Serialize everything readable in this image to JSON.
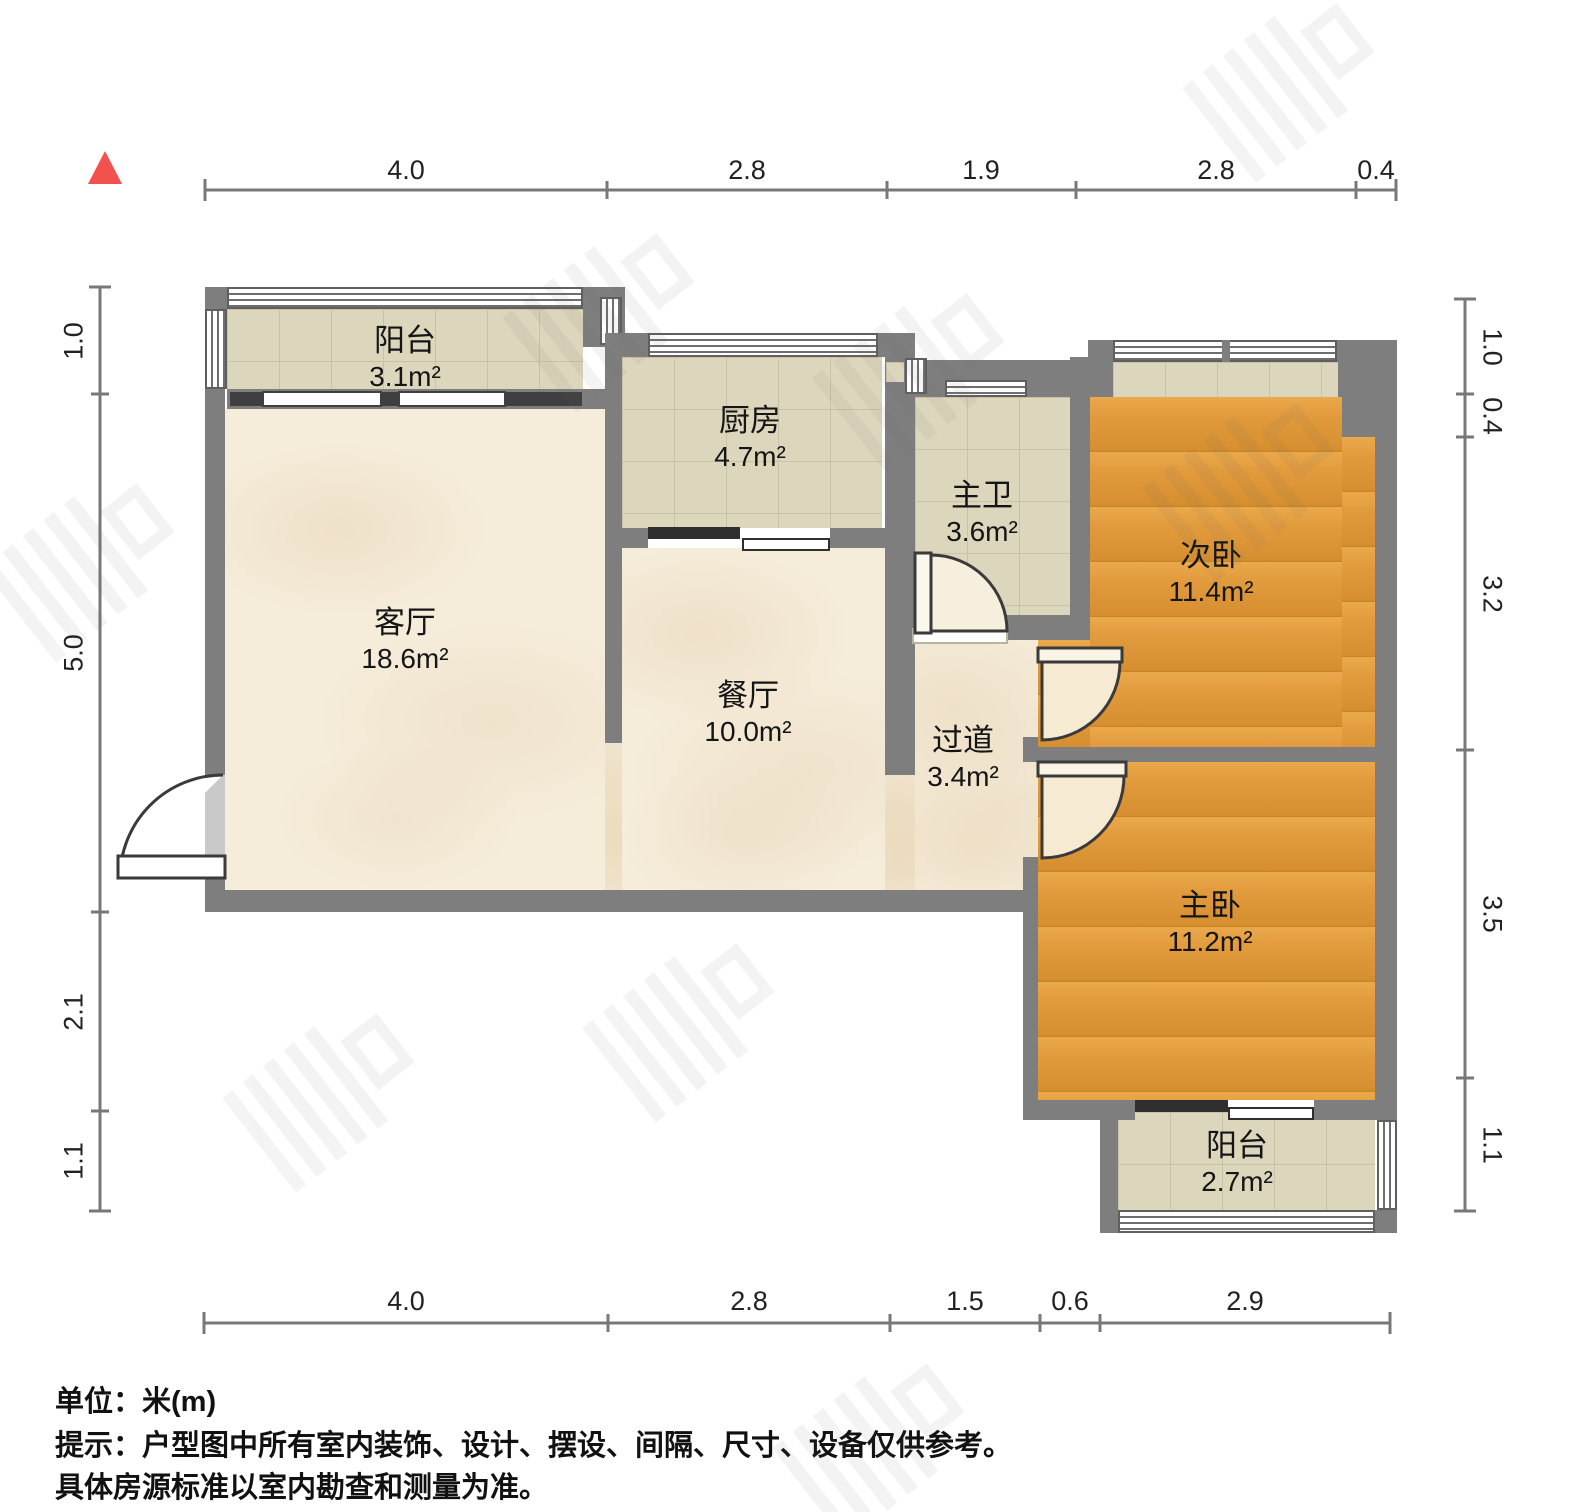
{
  "rooms": {
    "balcony_top": {
      "name": "阳台",
      "area": "3.1m²"
    },
    "kitchen": {
      "name": "厨房",
      "area": "4.7m²"
    },
    "bathroom": {
      "name": "主卫",
      "area": "3.6m²"
    },
    "bedroom_second": {
      "name": "次卧",
      "area": "11.4m²"
    },
    "living": {
      "name": "客厅",
      "area": "18.6m²"
    },
    "dining": {
      "name": "餐厅",
      "area": "10.0m²"
    },
    "hallway": {
      "name": "过道",
      "area": "3.4m²"
    },
    "bedroom_master": {
      "name": "主卧",
      "area": "11.2m²"
    },
    "balcony_bottom": {
      "name": "阳台",
      "area": "2.7m²"
    }
  },
  "dimensions": {
    "top": [
      "4.0",
      "2.8",
      "1.9",
      "2.8",
      "0.4"
    ],
    "bottom": [
      "4.0",
      "2.8",
      "1.5",
      "0.6",
      "2.9"
    ],
    "left": [
      "1.0",
      "5.0",
      "2.1",
      "1.1"
    ],
    "right": [
      "1.0",
      "0.4",
      "3.2",
      "3.5",
      "1.1"
    ]
  },
  "footer": {
    "unit_label": "单位：米(m)",
    "tip_line1": "提示：户型图中所有室内装饰、设计、摆设、间隔、尺寸、设备仅供参考。",
    "tip_line2": "具体房源标准以室内勘查和测量为准。"
  },
  "icons": {
    "north_arrow": "triangle-up"
  },
  "colors": {
    "wall": "#7e7e7e",
    "wood_floor": "#e19a3c",
    "tile_floor": "#dcd6bc",
    "marble_floor": "#f5ecda",
    "north_arrow": "#f2514e",
    "dimension_line": "#787878"
  }
}
